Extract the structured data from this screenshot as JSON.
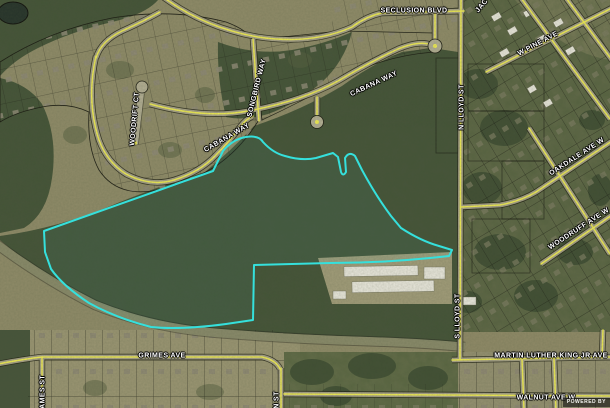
{
  "map": {
    "kind": "aerial-imagery-parcel-map",
    "highlight_boundary_color": "#35e0dc",
    "road_centerline_color": "#f0ec55",
    "watermark_text": "POWERED BY"
  },
  "street_labels": [
    {
      "id": "seclusion-blvd",
      "text": "SECLUSION BLVD"
    },
    {
      "id": "n-lloyd-st",
      "text": "N LLOYD ST"
    },
    {
      "id": "w-pine-ave",
      "text": "W PINE AVE"
    },
    {
      "id": "oakdale-ave-w",
      "text": "OAKDALE AVE W"
    },
    {
      "id": "woodruff-ave-w",
      "text": "WOODRUFF AVE W"
    },
    {
      "id": "cabana-way",
      "text": "CABANA WAY"
    },
    {
      "id": "songbird-way",
      "text": "SONGBIRD WAY"
    },
    {
      "id": "woodrift-ct",
      "text": "WOODRIFT CT"
    },
    {
      "id": "cabana-way-2",
      "text": "CABANA WAY"
    },
    {
      "id": "s-lloyd-st",
      "text": "S LLOYD ST"
    },
    {
      "id": "martin-luther-king-jr-ave",
      "text": "MARTIN LUTHER KING JR AVE"
    },
    {
      "id": "grimes-ave",
      "text": "GRIMES AVE"
    },
    {
      "id": "walnut-ave-w",
      "text": "WALNUT AVE W"
    },
    {
      "id": "james-st",
      "text": "JAMES ST"
    },
    {
      "id": "n-st-partial",
      "text": "N ST"
    },
    {
      "id": "jac-partial",
      "text": "JAC"
    }
  ]
}
